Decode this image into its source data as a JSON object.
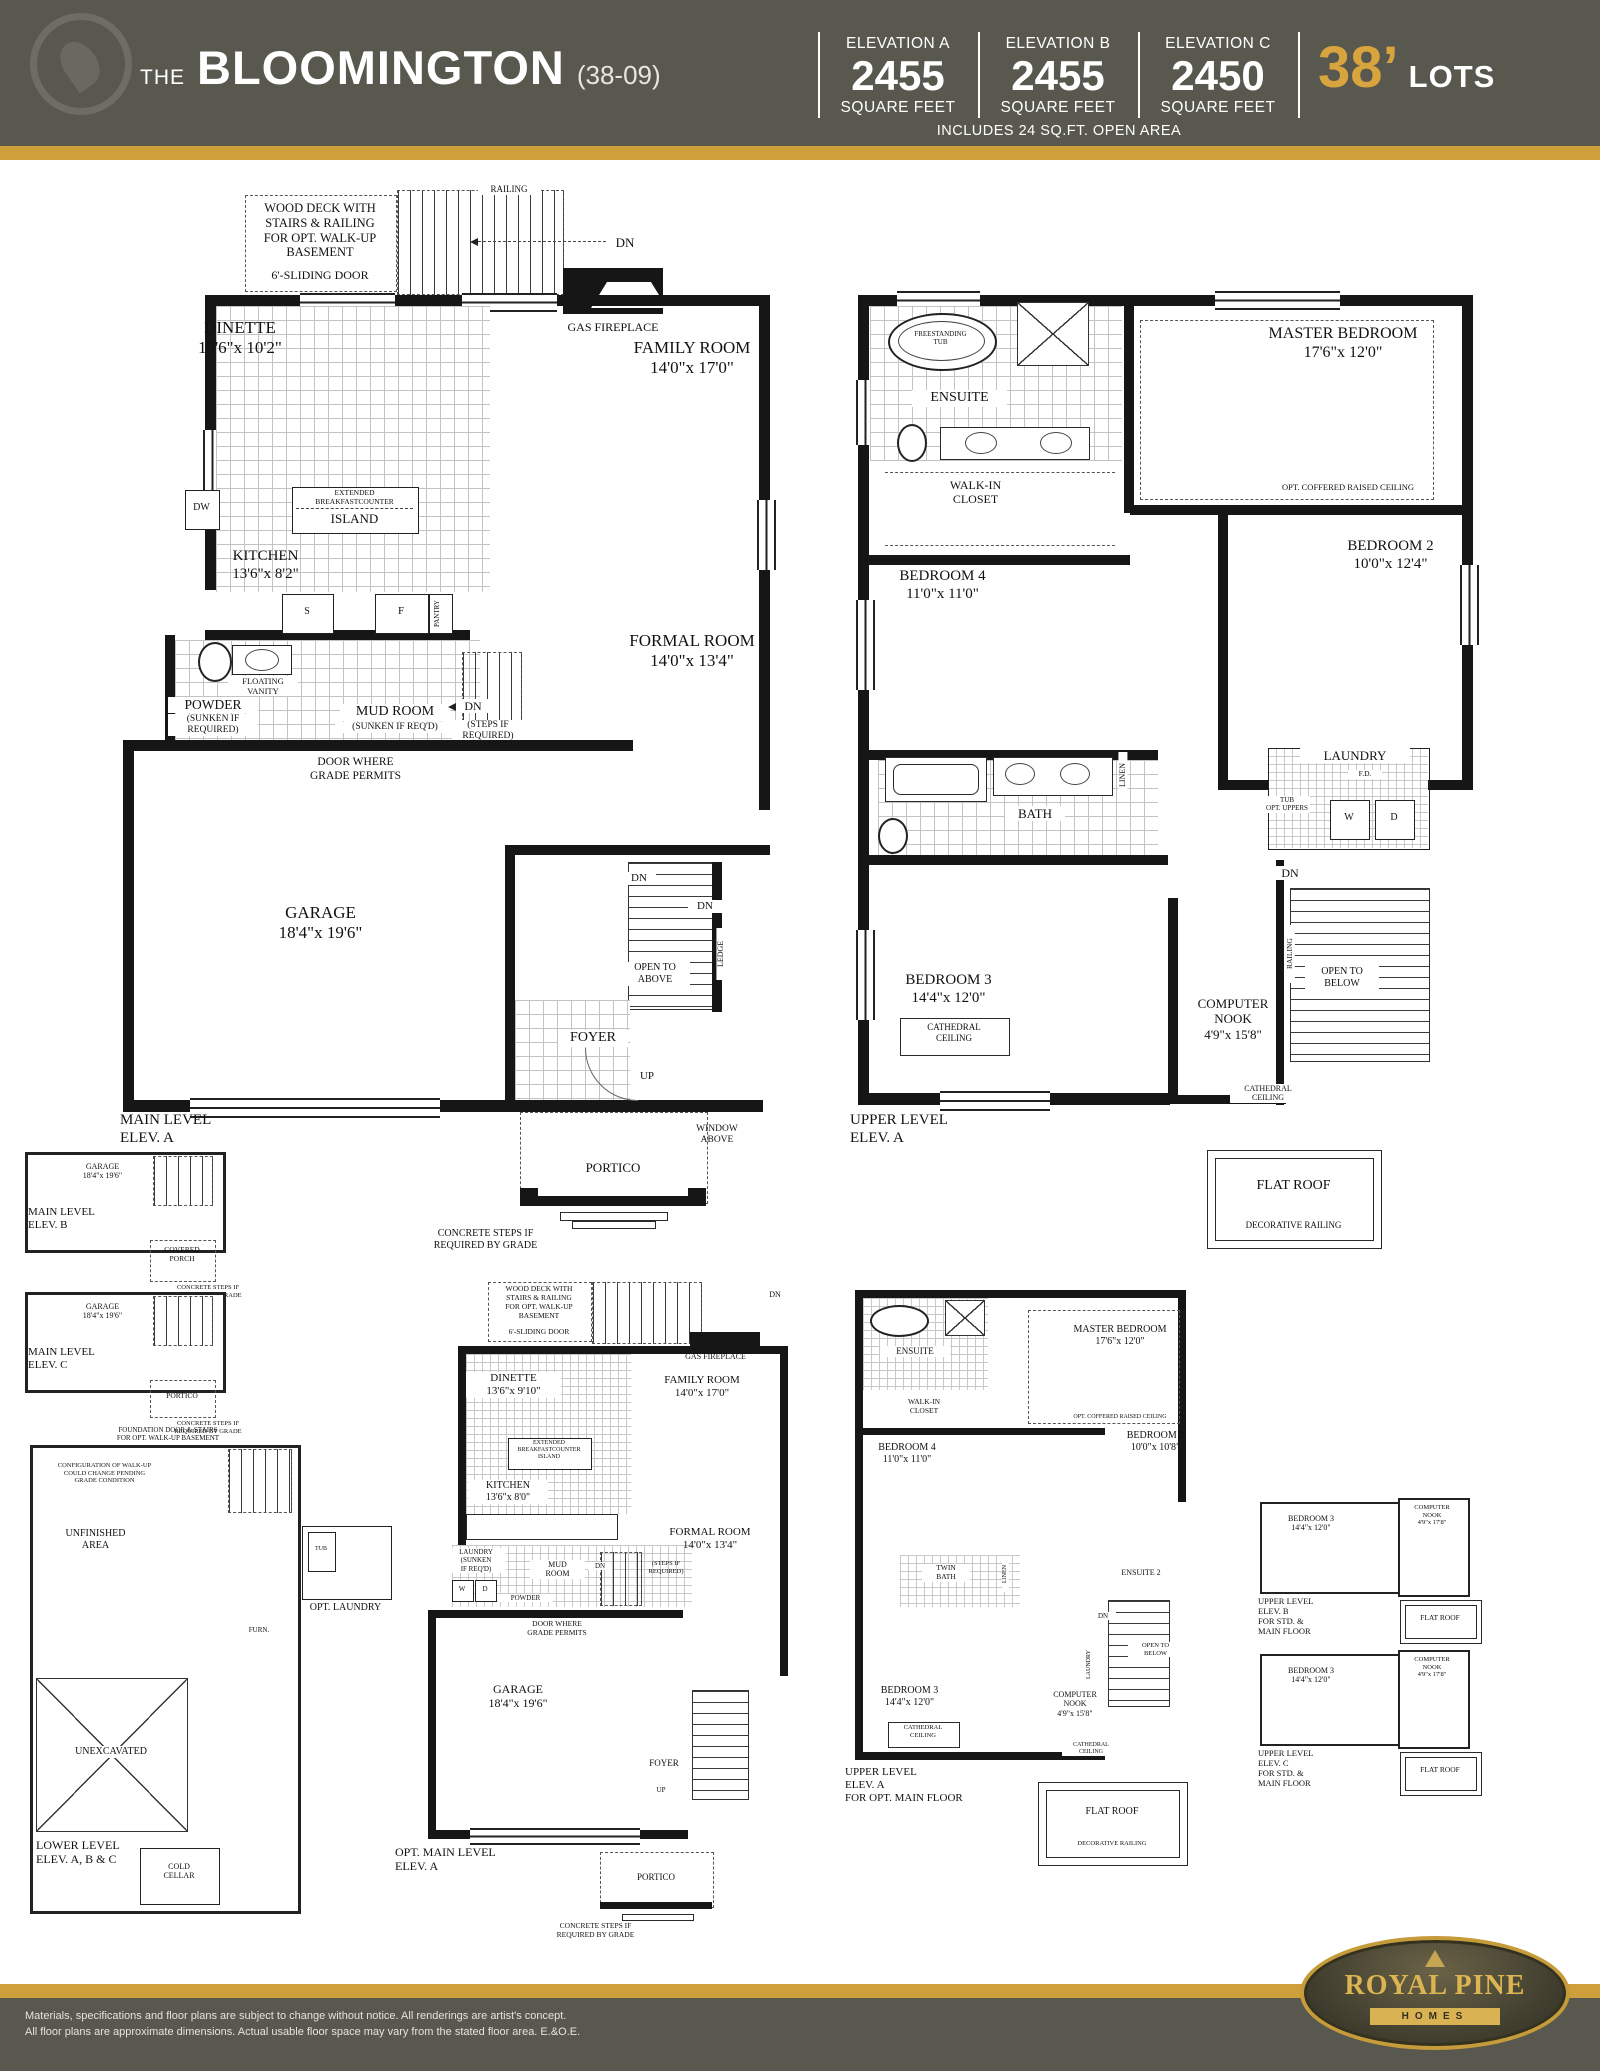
{
  "header": {
    "title_prefix": "THE",
    "title_name": "BLOOMINGTON",
    "title_code": "(38-09)",
    "elevations": [
      {
        "label": "ELEVATION A",
        "value": "2455",
        "unit": "SQUARE FEET"
      },
      {
        "label": "ELEVATION B",
        "value": "2455",
        "unit": "SQUARE FEET"
      },
      {
        "label": "ELEVATION C",
        "value": "2450",
        "unit": "SQUARE FEET"
      }
    ],
    "lots_value": "38’",
    "lots_label": "LOTS",
    "open_area_note": "INCLUDES 24 SQ.FT. OPEN AREA"
  },
  "colors": {
    "header_bg": "#59584e",
    "gold_bar": "#cf9f3b",
    "accent_gold_text": "#d7a43e"
  },
  "plans": {
    "main_a": {
      "plan_name": "MAIN LEVEL\nELEV. A",
      "deck_note": "WOOD DECK WITH\nSTAIRS & RAILING\nFOR OPT. WALK-UP\nBASEMENT",
      "sliding_door": "6'-SLIDING DOOR",
      "railing": "RAILING",
      "dn_deck": "DN",
      "gas_fireplace": "GAS FIREPLACE",
      "dinette": "DINETTE\n13'6\"x 10'2\"",
      "family_room": "FAMILY ROOM\n14'0\"x 17'0\"",
      "island_top": "EXTENDED\nBREAKFASTCOUNTER",
      "island": "ISLAND",
      "dw": "DW",
      "kitchen": "KITCHEN\n13'6\"x 8'2\"",
      "stove": "S",
      "fridge": "F",
      "pantry": "PANTRY",
      "floating_vanity": "FLOATING\nVANITY",
      "powder": "POWDER",
      "powder_sub": "(SUNKEN IF\nREQUIRED)",
      "mud_room": "MUD ROOM",
      "mud_room_sub": "(SUNKEN IF REQ'D)",
      "dn_mud": "DN",
      "steps_note": "(STEPS IF\nREQUIRED)",
      "formal_room": "FORMAL ROOM\n14'0\"x 13'4\"",
      "door_grade": "DOOR WHERE\nGRADE PERMITS",
      "garage": "GARAGE\n18'4\"x 19'6\"",
      "open_above": "OPEN TO\nABOVE",
      "dn_stair": "DN",
      "dn_stair2": "DN",
      "ledge": "LEDGE",
      "foyer": "FOYER",
      "up": "UP",
      "window_above": "WINDOW\nABOVE",
      "portico": "PORTICO",
      "concrete_note": "CONCRETE STEPS IF\nREQUIRED BY GRADE"
    },
    "upper_a": {
      "plan_name": "UPPER LEVEL\nELEV. A",
      "tub": "FREESTANDING\nTUB",
      "ensuite": "ENSUITE",
      "master": "MASTER BEDROOM\n17'6\"x 12'0\"",
      "coffered": "OPT. COFFERED RAISED CEILING",
      "walk_in": "WALK-IN\nCLOSET",
      "bedroom4": "BEDROOM 4\n11'0\"x 11'0\"",
      "bedroom2": "BEDROOM 2\n10'0\"x 12'4\"",
      "bath": "BATH",
      "linen": "LINEN",
      "laundry": "LAUNDRY",
      "fd": "F.D.",
      "tub_uppers": "TUB\nOPT. UPPERS",
      "washer": "W",
      "dryer": "D",
      "dn": "DN",
      "railing": "RAILING",
      "open_below": "OPEN TO\nBELOW",
      "bedroom3": "BEDROOM 3\n14'4\"x 12'0\"",
      "cathedral": "CATHEDRAL\nCEILING",
      "nook": "COMPUTER\nNOOK\n4'9\"x 15'8\"",
      "cathedral2": "CATHEDRAL\nCEILING",
      "flat_roof": "FLAT ROOF",
      "dec_railing": "DECORATIVE RAILING"
    },
    "main_b": {
      "plan_name": "MAIN LEVEL\nELEV. B",
      "garage": "GARAGE\n18'4\"x 19'6\"",
      "covered_porch": "COVERED\nPORCH",
      "note": "CONCRETE STEPS IF\nREQUIRED BY GRADE"
    },
    "main_c": {
      "plan_name": "MAIN LEVEL\nELEV. C",
      "garage": "GARAGE\n18'4\"x 19'6\"",
      "portico": "PORTICO",
      "note": "CONCRETE STEPS IF\nREQUIRED BY GRADE"
    },
    "lower": {
      "plan_name": "LOWER LEVEL\nELEV. A, B & C",
      "foundation_note": "FOUNDATION DOOR & STAIRS\nFOR OPT. WALK-UP BASEMENT",
      "config_note": "CONFIGURATION OF WALK-UP\nCOULD CHANGE PENDING\nGRADE CONDITION",
      "unfinished": "UNFINISHED\nAREA",
      "opt_laundry": "OPT. LAUNDRY",
      "tub": "TUB",
      "furnace": "FURN.",
      "unexcavated": "UNEXCAVATED",
      "cold_cellar": "COLD\nCELLAR"
    },
    "opt_main_a": {
      "plan_name": "OPT. MAIN LEVEL\nELEV. A",
      "deck_note": "WOOD DECK WITH\nSTAIRS & RAILING\nFOR OPT. WALK-UP\nBASEMENT",
      "sliding_door": "6'-SLIDING DOOR",
      "dn_deck": "DN",
      "gas_fireplace": "GAS FIREPLACE",
      "dinette": "DINETTE\n13'6\"x 9'10\"",
      "family_room": "FAMILY ROOM\n14'0\"x 17'0\"",
      "island": "EXTENDED\nBREAKFASTCOUNTER\nISLAND",
      "kitchen": "KITCHEN\n13'6\"x 8'0\"",
      "laundry": "LAUNDRY\n(SUNKEN\nIF REQ'D)",
      "washer": "W",
      "dryer": "D",
      "mud_room": "MUD\nROOM",
      "powder": "POWDER",
      "dn_mud": "DN",
      "steps_note": "(STEPS IF\nREQUIRED)",
      "formal_room": "FORMAL ROOM\n14'0\"x 13'4\"",
      "door_grade": "DOOR WHERE\nGRADE PERMITS",
      "garage": "GARAGE\n18'4\"x 19'6\"",
      "foyer": "FOYER",
      "up": "UP",
      "portico": "PORTICO",
      "concrete_note": "CONCRETE STEPS IF\nREQUIRED BY GRADE"
    },
    "upper_opt_a": {
      "plan_name": "UPPER LEVEL\nELEV. A\nFOR OPT. MAIN FLOOR",
      "ensuite": "ENSUITE",
      "master": "MASTER BEDROOM\n17'6\"x 12'0\"",
      "coffered": "OPT. COFFERED RAISED CEILING",
      "walk_in": "WALK-IN\nCLOSET",
      "bedroom4": "BEDROOM 4\n11'0\"x 11'0\"",
      "bedroom2": "BEDROOM 2\n10'0\"x 10'8\"",
      "twin_bath": "TWIN\nBATH",
      "linen": "LINEN",
      "ensuite2": "ENSUITE 2",
      "laundry": "LAUNDRY",
      "dn": "DN",
      "open_below": "OPEN TO\nBELOW",
      "bedroom3": "BEDROOM 3\n14'4\"x 12'0\"",
      "cathedral": "CATHEDRAL\nCEILING",
      "nook": "COMPUTER\nNOOK\n4'9\"x 15'8\"",
      "cathedral2": "CATHEDRAL\nCEILING",
      "flat_roof": "FLAT ROOF",
      "dec_railing": "DECORATIVE RAILING"
    },
    "upper_b": {
      "plan_name": "UPPER LEVEL\nELEV. B\nFOR STD. &\nMAIN FLOOR",
      "bedroom3": "BEDROOM 3\n14'4\"x 12'0\"",
      "nook": "COMPUTER\nNOOK\n4'9\"x 17'8\"",
      "flat_roof": "FLAT ROOF"
    },
    "upper_c": {
      "plan_name": "UPPER LEVEL\nELEV. C\nFOR STD. &\nMAIN FLOOR",
      "bedroom3": "BEDROOM 3\n14'4\"x 12'0\"",
      "nook": "COMPUTER\nNOOK\n4'9\"x 17'8\"",
      "flat_roof": "FLAT ROOF"
    }
  },
  "footer": {
    "disclaimer_line1": "Materials, specifications and floor plans are subject to change without notice. All renderings are artist's concept.",
    "disclaimer_line2": "All floor plans are approximate dimensions. Actual usable floor space may vary from the stated floor area. E.&O.E.",
    "logo_name": "ROYAL PINE",
    "logo_sub": "HOMES"
  }
}
